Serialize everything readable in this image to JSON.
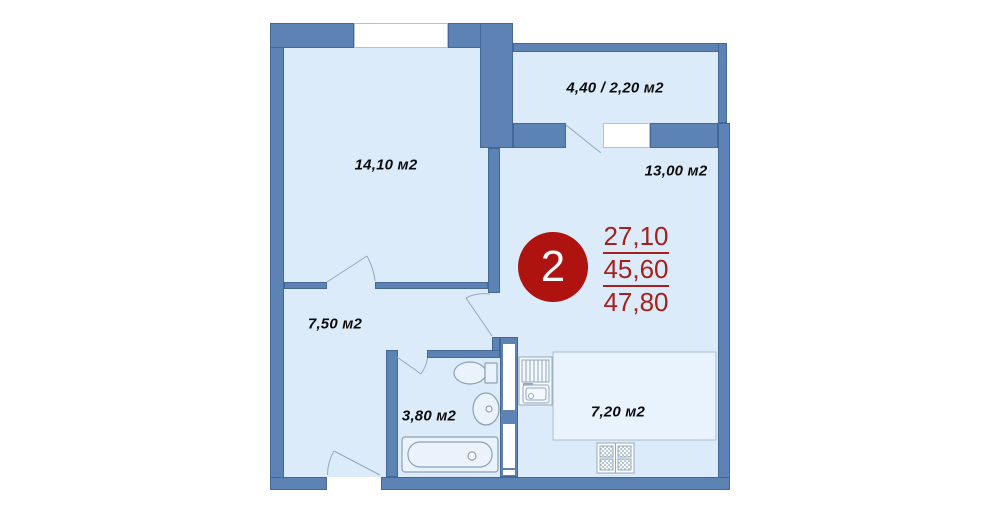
{
  "unit": {
    "number": "2"
  },
  "area_values": {
    "living": "27,10",
    "total": "45,60",
    "overall": "47,80"
  },
  "rooms": {
    "bedroom": "14,10 м2",
    "balcony": "4,40 / 2,20 м2",
    "living": "13,00 м2",
    "hallway": "7,50 м2",
    "bathroom": "3,80 м2",
    "kitchen": "7,20 м2"
  },
  "colors": {
    "wall": "#5d82b4",
    "floor": "#dcebfa",
    "work_zone": "#e9f3fd",
    "badge_red": "#ae130f",
    "area_text_red": "#a5211e",
    "fixture_outline": "#8b9fb6"
  }
}
